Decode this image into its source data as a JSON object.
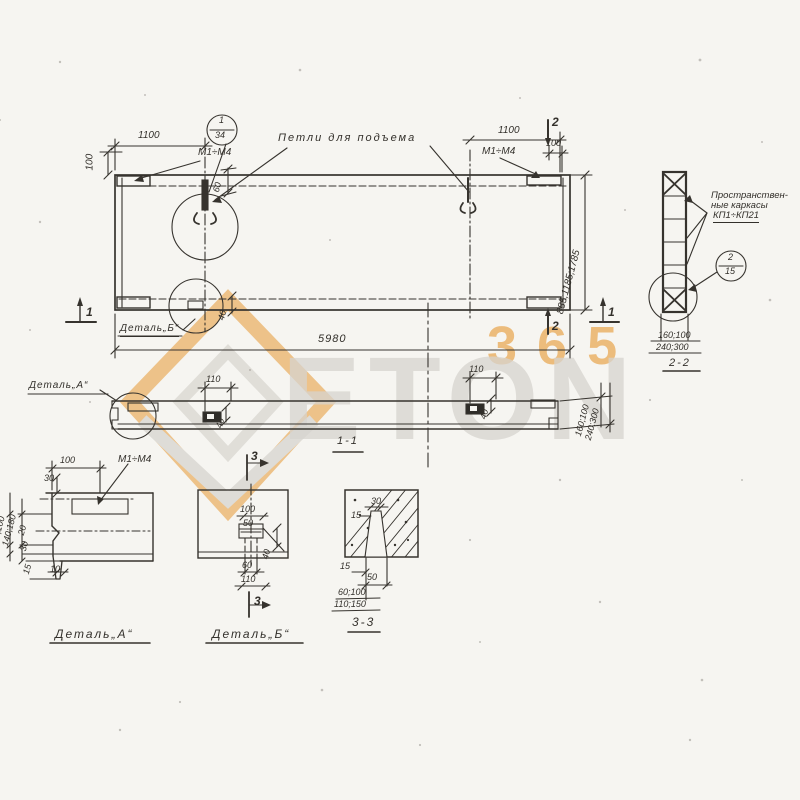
{
  "watermark": {
    "brand": "ETON",
    "number": "365"
  },
  "plan": {
    "lifting_note": "Петли для подъема",
    "mark_left": "М1÷М4",
    "mark_right": "М1÷М4",
    "callout_top": "1",
    "callout_bottom": "34",
    "dim_left_1100": "1100",
    "dim_left_100": "100",
    "dim_right_1100": "1100",
    "dim_right_100": "100",
    "dim_loop_60": "60",
    "dim_overall": "5980",
    "dim_heights": "885;1185;1785",
    "dim_detb_40": "40",
    "detail_b_ref": "Деталь„Б“",
    "marker_1": "1",
    "marker_2": "2"
  },
  "section11": {
    "label": "1-1",
    "detail_a_ref": "Деталь„А“",
    "dim_110": "110",
    "dim_40": "40",
    "dim_right_row1": "160;100",
    "dim_right_row2": "240;300"
  },
  "section22": {
    "label": "2-2",
    "note_line1": "Пространствен-",
    "note_line2": "ные каркасы",
    "note_line3": "КП1÷КП21",
    "callout_top": "2",
    "callout_bottom": "15",
    "dim_row1": "160;100",
    "dim_row2": "240;300"
  },
  "detail_a": {
    "label": "Деталь„А“",
    "mark": "М1÷М4",
    "dim_100": "100",
    "dim_30": "30",
    "dim_rot1": "60;100",
    "dim_rot2": "140;180",
    "dim_20": "20",
    "dim_30b": "30",
    "dim_15": "15",
    "dim_10": "10"
  },
  "detail_b": {
    "label": "Деталь„Б“",
    "marker": "3",
    "dim_100": "100",
    "dim_50": "50",
    "dim_40": "40",
    "dim_60": "60",
    "dim_110": "110"
  },
  "section33": {
    "label": "3-3",
    "dim_30": "30",
    "dim_15a": "15",
    "dim_15b": "15",
    "dim_50": "50",
    "dim_row1": "60;100",
    "dim_row2": "110;150"
  }
}
